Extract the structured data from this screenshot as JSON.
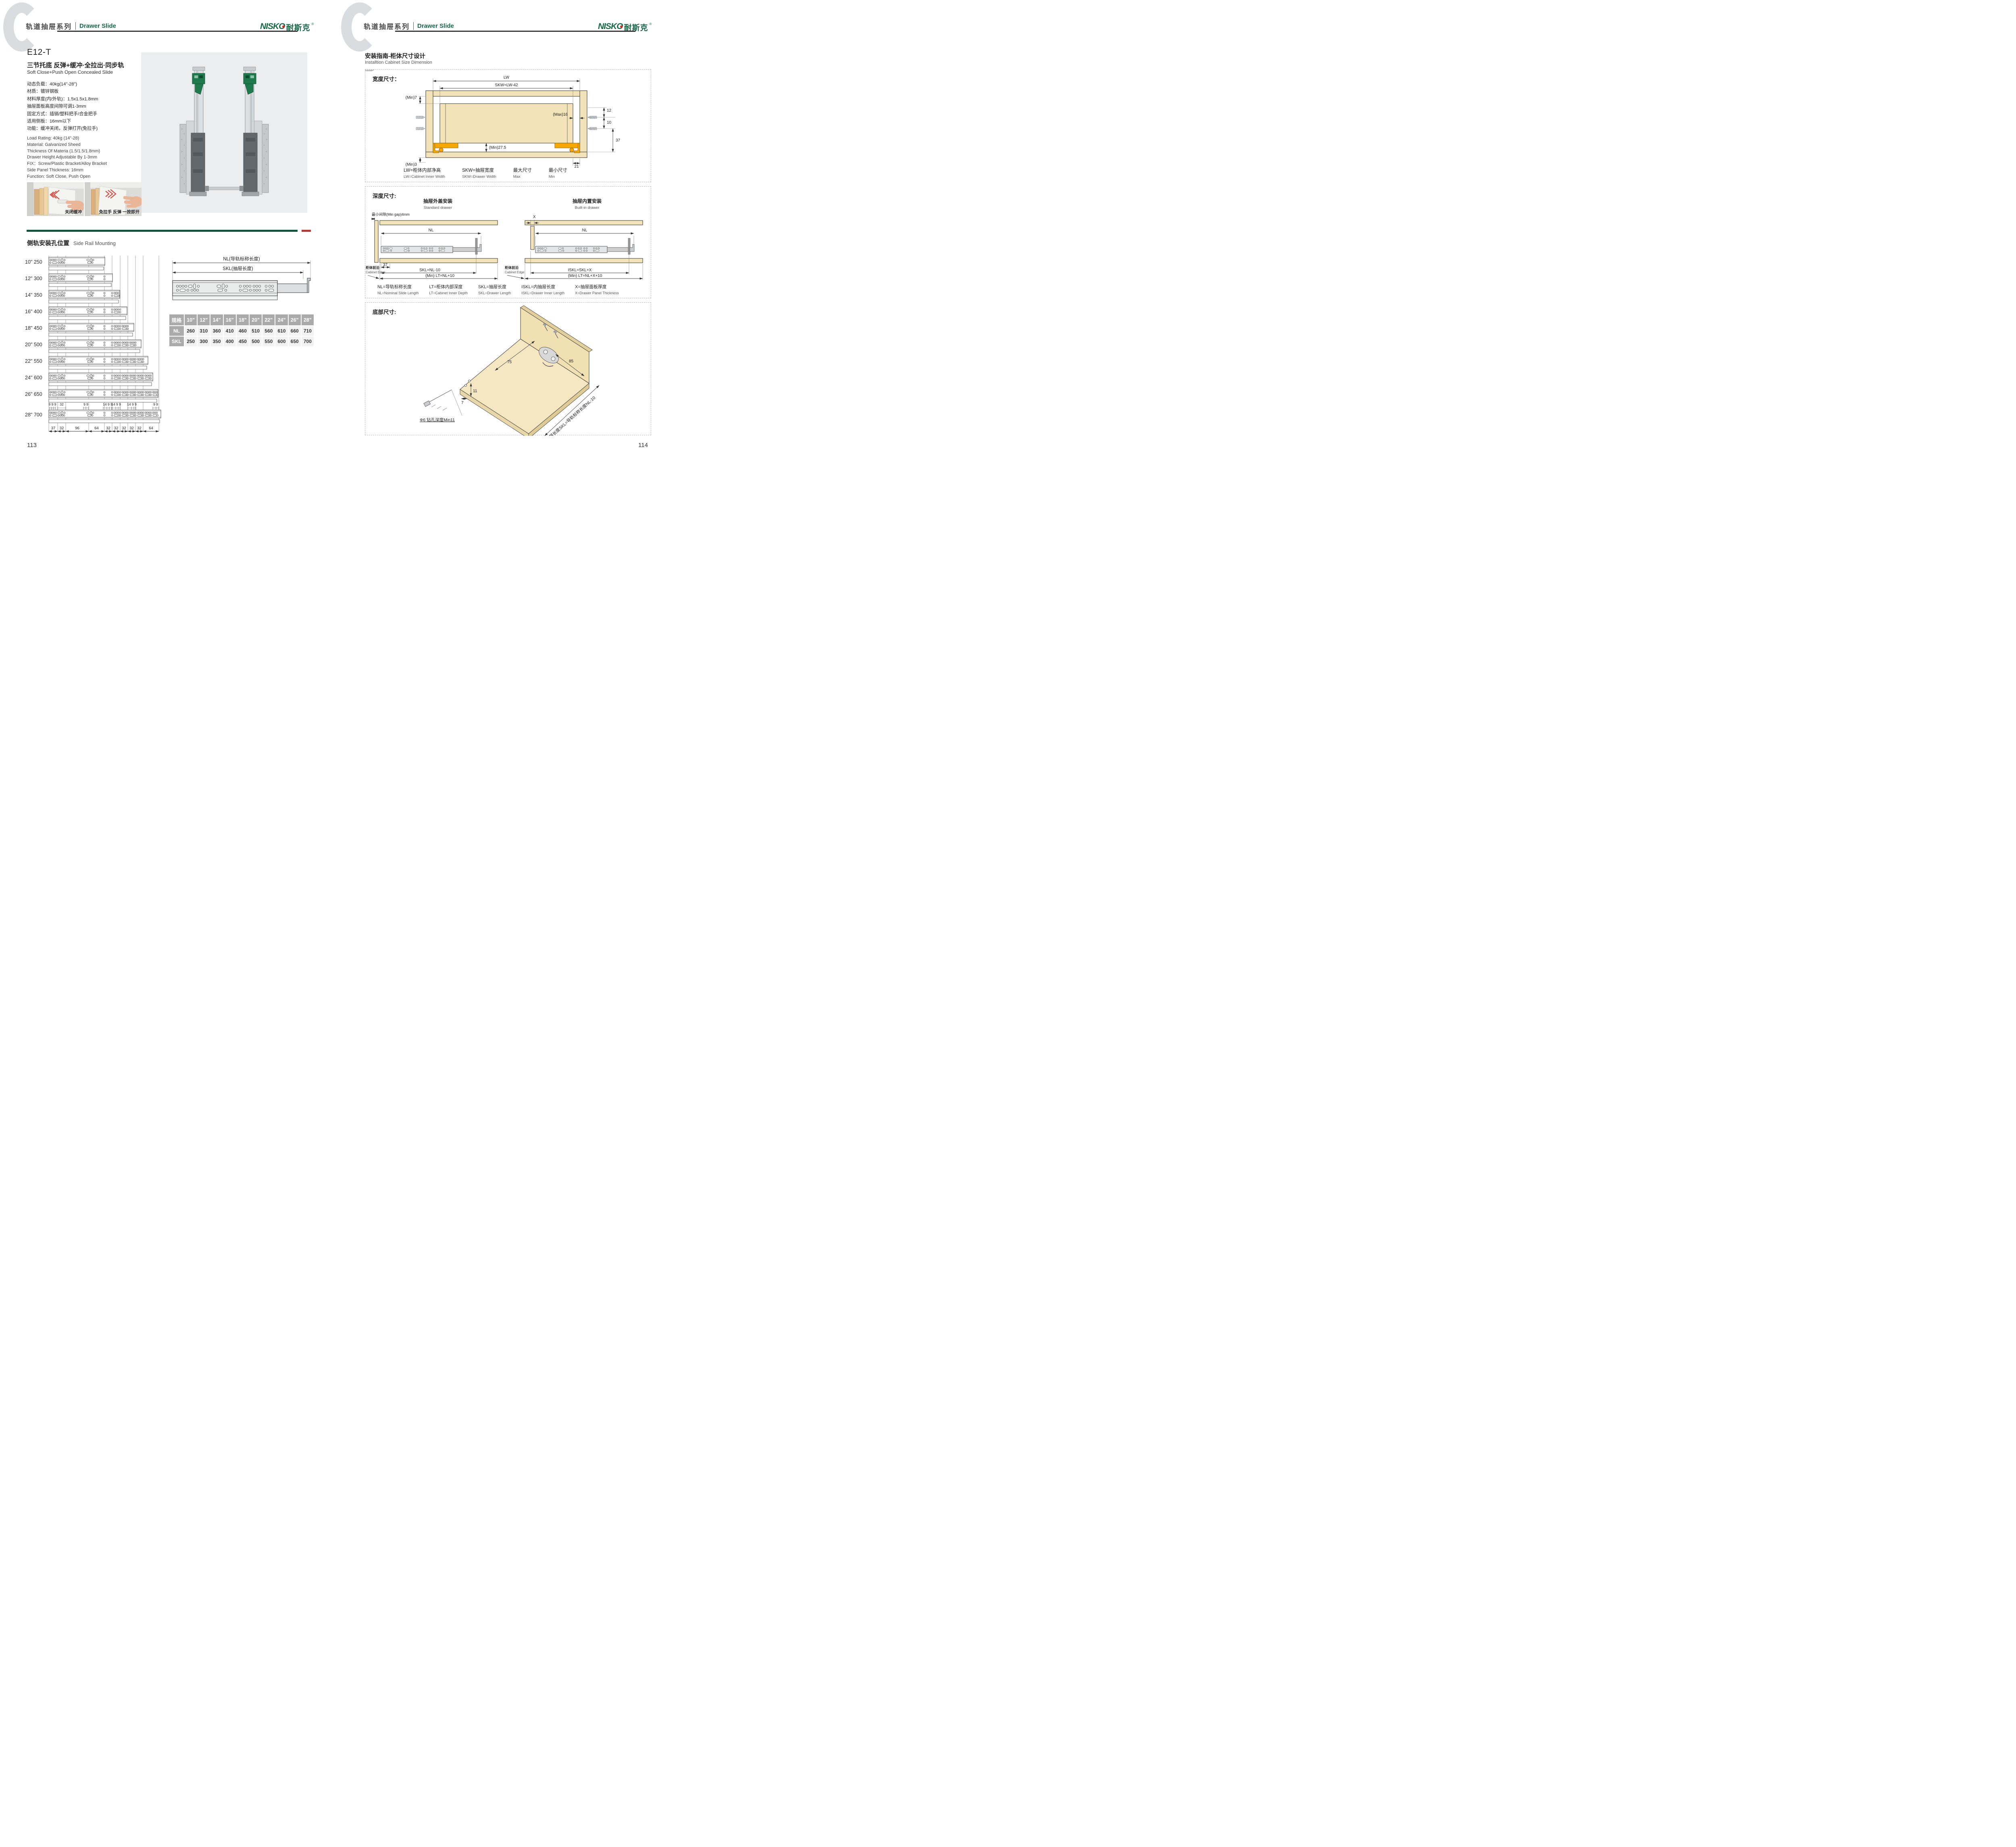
{
  "colors": {
    "brand_green": "#17694A",
    "divider_green": "#14523A",
    "divider_red": "#B23A3A",
    "wood": "#F2E3B8",
    "orange": "#F6A800",
    "table_header_gray": "#ABABAB"
  },
  "header": {
    "series_cn": "轨道抽屉系列",
    "series_en": "Drawer Slide",
    "logo": {
      "latin": "NISKO",
      "cjk": "耐斯克",
      "registered": "®"
    }
  },
  "left_page": {
    "model": "E12-T",
    "subtitle_cn": "三节托底 反弹+缓冲·全拉出·同步轨",
    "subtitle_en": "Soft Close+Push Open Concealed Slide",
    "specs_cn": [
      "动态负载：40kg(14\"-28\")",
      "材质：镀锌钢板",
      "材料厚度(内/外轨)：1.5x1.5x1.8mm",
      "抽屉面板高度间隙可调1-3mm",
      "固定方式：插销/塑料把手/合金把手",
      "适用侧板：16mm以下",
      "功能：缓冲关闭，反弹打开(免拉手)"
    ],
    "specs_en": [
      "Load Rating: 40kg (14\"-28)",
      "Material: Galvanized Sheed",
      "Thickness Of Materia (1.5/1.5/1.8mm)",
      "Drawer Height Adjustable By 1-3mm",
      "FIX：Screw/Plastic Bracket/Alloy Bracket",
      "Side Panel Thickness: 16mm",
      "Function: Soft Close, Push Open"
    ],
    "photo_caption_1": "关闭缓冲",
    "photo_caption_2": "免拉手 反弹 一按即开",
    "section_title_cn": "侧轨安装孔位置",
    "section_title_en": "Side Rail Mounting",
    "rails": {
      "rows": [
        {
          "inch": "10\"",
          "mm": "250"
        },
        {
          "inch": "12\"",
          "mm": "300"
        },
        {
          "inch": "14\"",
          "mm": "350"
        },
        {
          "inch": "16\"",
          "mm": "400"
        },
        {
          "inch": "18\"",
          "mm": "450"
        },
        {
          "inch": "20\"",
          "mm": "500"
        },
        {
          "inch": "22\"",
          "mm": "550"
        },
        {
          "inch": "24\"",
          "mm": "600"
        },
        {
          "inch": "26\"",
          "mm": "650"
        },
        {
          "inch": "28\"",
          "mm": "700"
        }
      ],
      "top_dims": [
        "9 9 9",
        "32",
        "9 9",
        "14 9 9",
        "14 9 9",
        "14 9 9",
        "9 9"
      ],
      "bottom_dims": [
        "37",
        "32",
        "96",
        "64",
        "32",
        "32",
        "32",
        "32",
        "32",
        "64"
      ]
    },
    "slide_diagram": {
      "nl_label": "NL(导轨标称长度)",
      "skl_label": "SKL(抽屉长度)"
    },
    "size_table": {
      "spec_header": "规格",
      "sizes": [
        "10\"",
        "12\"",
        "14\"",
        "16\"",
        "18\"",
        "20\"",
        "22\"",
        "24\"",
        "26\"",
        "28\""
      ],
      "nl_label": "NL",
      "nl": [
        "260",
        "310",
        "360",
        "410",
        "460",
        "510",
        "560",
        "610",
        "660",
        "710"
      ],
      "skl_label": "SKL",
      "skl": [
        "250",
        "300",
        "350",
        "400",
        "450",
        "500",
        "550",
        "600",
        "650",
        "700"
      ]
    },
    "page_number": "113"
  },
  "right_page": {
    "title_cn": "安装指南-柜体尺寸设计",
    "title_en": "Installtion Cabinet Size Dimension",
    "width_panel": {
      "label": "宽度尺寸：",
      "dims": {
        "lw": "LW",
        "skw": "SKW=LW-42",
        "min7": "(Min)7",
        "max16": "(Max)16",
        "d12": "12",
        "d10": "10",
        "d37": "37",
        "min275": "(Min)27.5",
        "min3": "(Min)3",
        "d21": "21"
      },
      "legend": [
        {
          "cn": "LW=柜体内部净高",
          "en": "LW=Cabinet Inner Width"
        },
        {
          "cn": "SKW=抽屉宽度",
          "en": "SKW=Drawer  Width"
        },
        {
          "cn": "最大尺寸",
          "en": "Max"
        },
        {
          "cn": "最小尺寸",
          "en": "Min"
        }
      ]
    },
    "depth_panel": {
      "label": "深度尺寸:",
      "min_gap": "最小间隙(Min gap)4mm",
      "standard": {
        "title_cn": "抽屉外盖安装",
        "title_en": "Standard drawer",
        "nl": "NL",
        "d37": "37",
        "skl": "SKL=NL-10",
        "lt": "(Min) LT=NL+10",
        "edge_cn": "柜体前沿",
        "edge_en": "Cabinet Edge"
      },
      "builtin": {
        "title_cn": "抽屉内置安装",
        "title_en": "Built-in drawer",
        "x": "X",
        "nl": "NL",
        "iskl": "ISKL=SKL+X",
        "lt": "(Min) LT=NL+X+10",
        "edge_cn": "柜体前沿",
        "edge_en": "Cabinet Edge"
      },
      "legend": [
        {
          "cn": "NL=导轨标称长度",
          "en": "NL=Nominal Slide Length"
        },
        {
          "cn": "LT=柜体内部深度",
          "en": "LT=Cabinet Inner Depth"
        },
        {
          "cn": "SKL=抽屉长度",
          "en": "SKL=Drawer Length"
        },
        {
          "cn": "ISKL=内抽屉长度",
          "en": "ISKL=Drawer Inner Length"
        },
        {
          "cn": "X=抽屉面板厚度",
          "en": "X=Drawer Panel Thickness"
        }
      ]
    },
    "bottom_panel": {
      "label": "底部尺寸:",
      "d75": "75",
      "d85": "85",
      "d11": "11",
      "d7": "7",
      "drill_note": "Φ6 钻孔深度Min11",
      "skl_note": "抽屉长度SKL=导轨标称长度NL-10"
    },
    "page_number": "114"
  }
}
